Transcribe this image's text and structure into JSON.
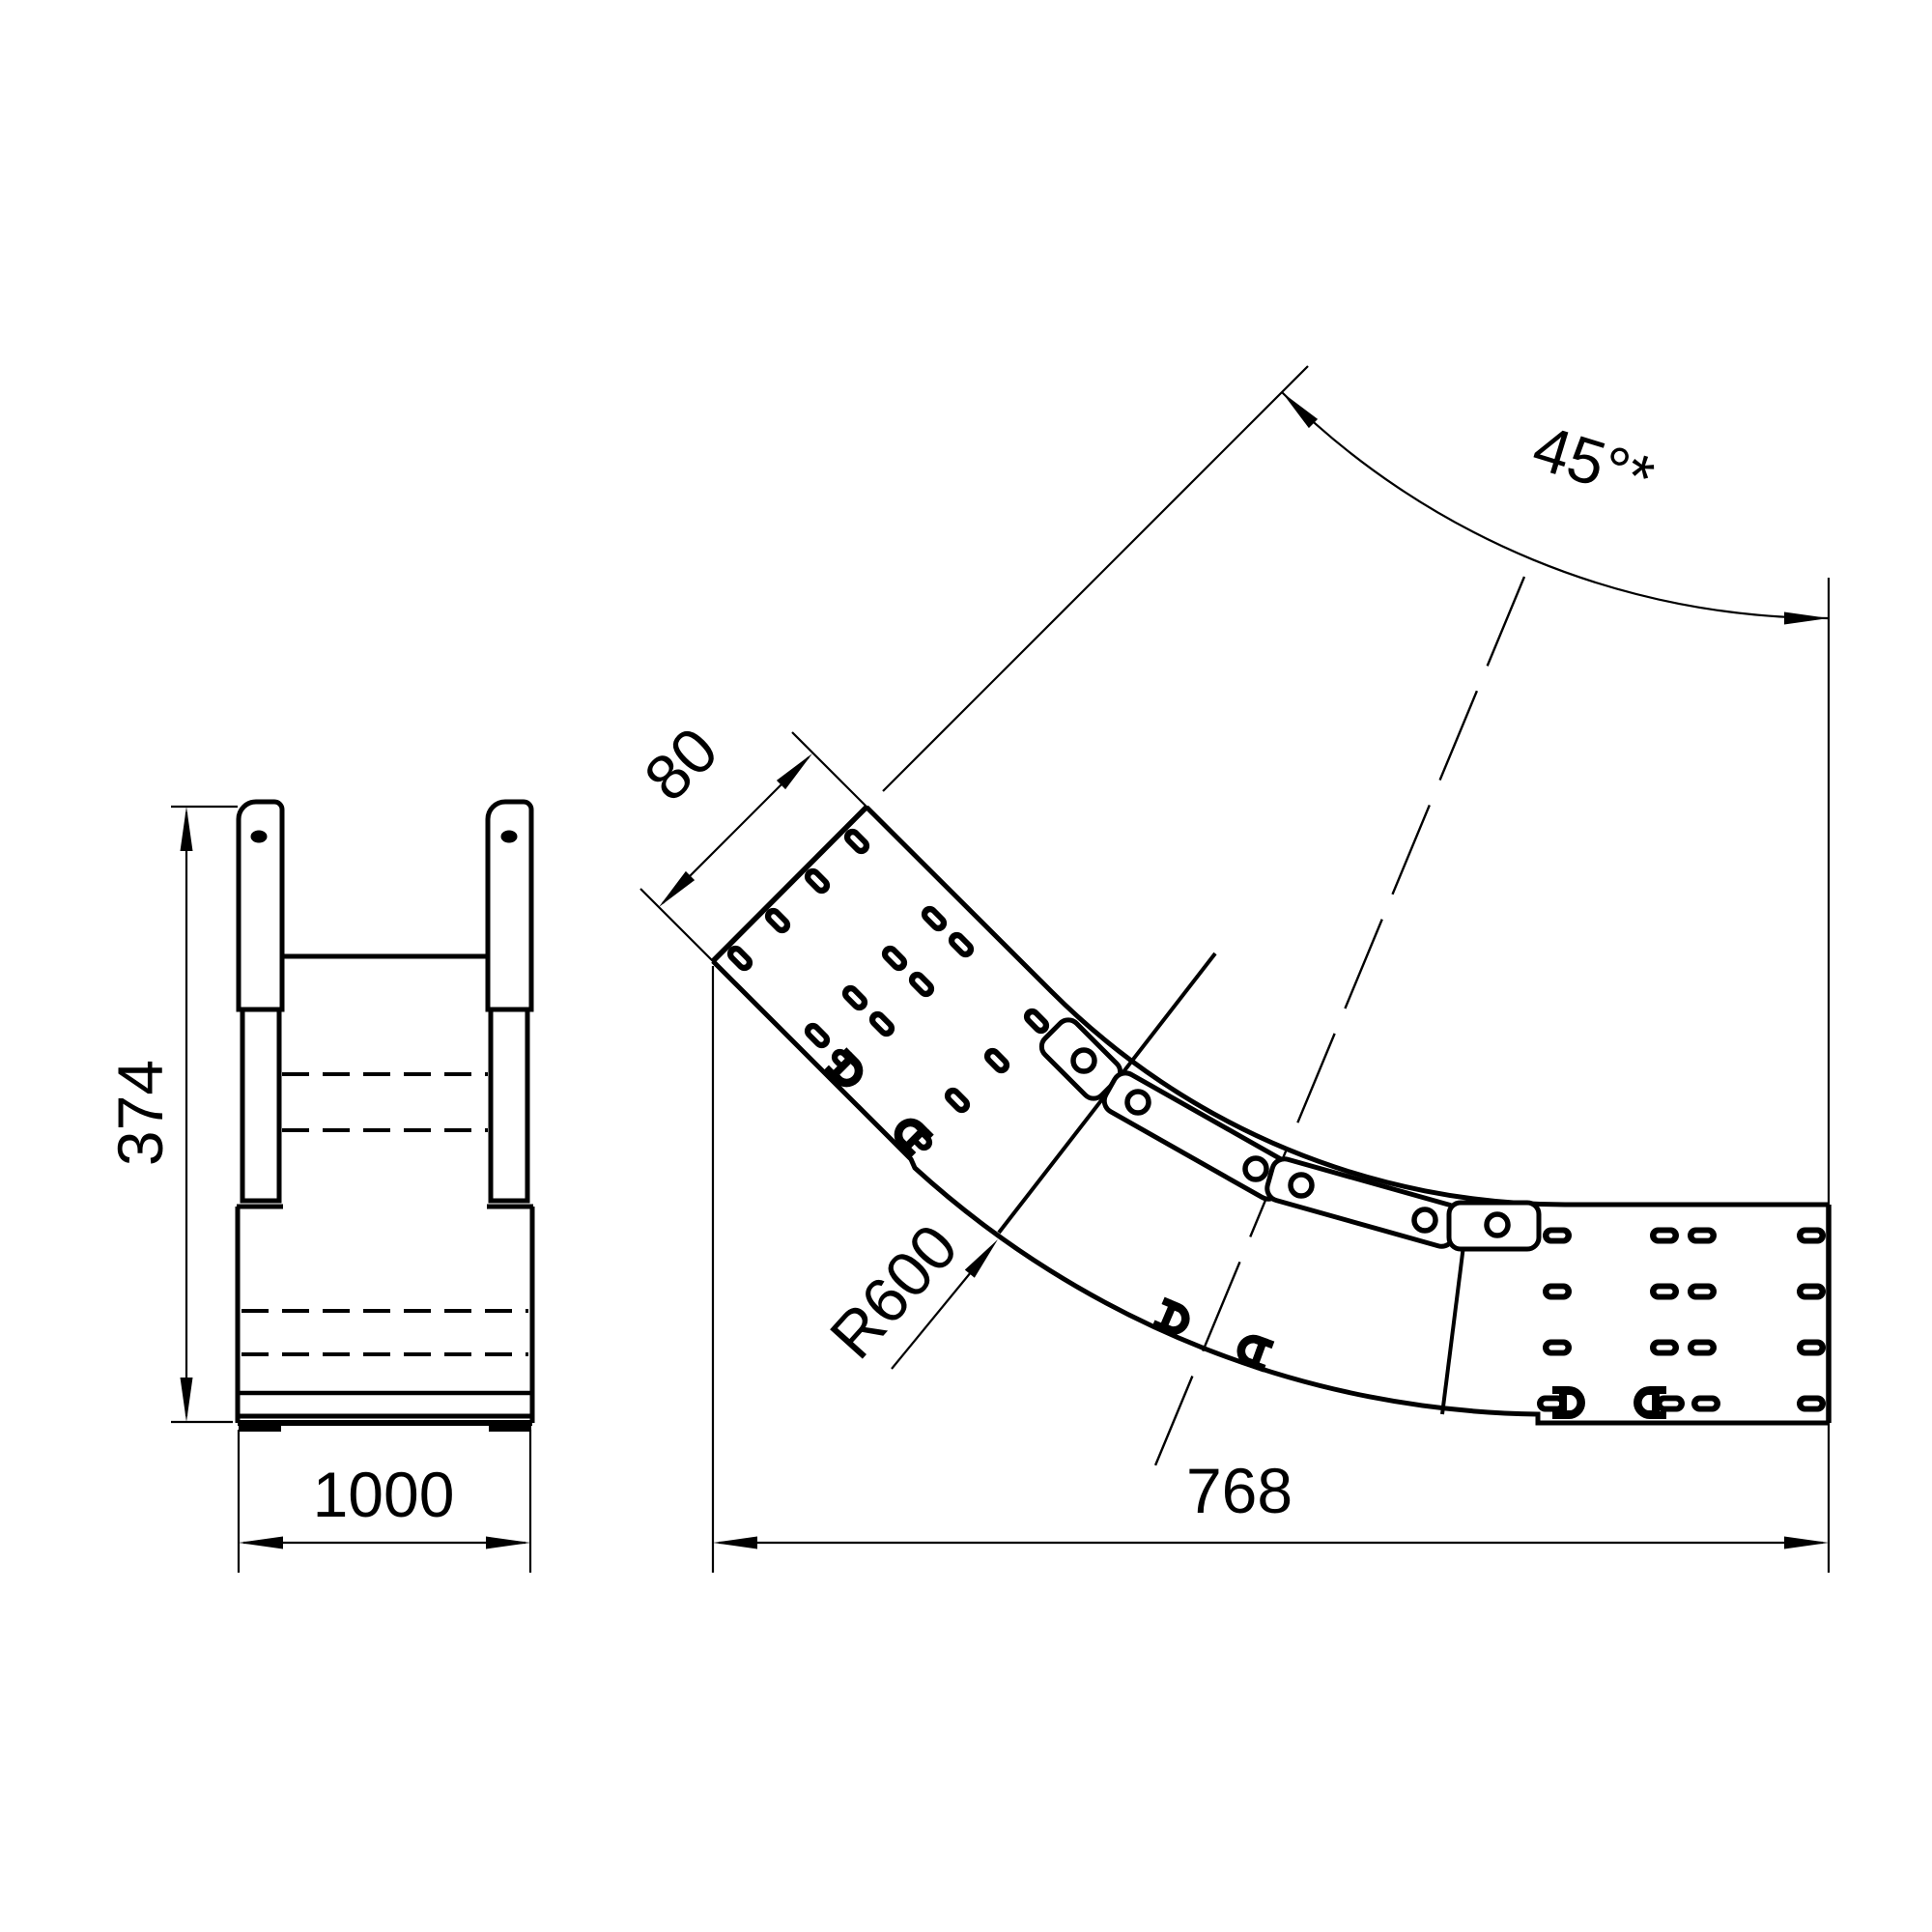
{
  "colors": {
    "line": "#000000",
    "background": "#ffffff"
  },
  "front_view": {
    "height_label": "374",
    "width_label": "1000"
  },
  "plan_view": {
    "rail_height_label": "80",
    "radius_label": "R600",
    "length_label": "768",
    "angle_label": "45°*"
  }
}
